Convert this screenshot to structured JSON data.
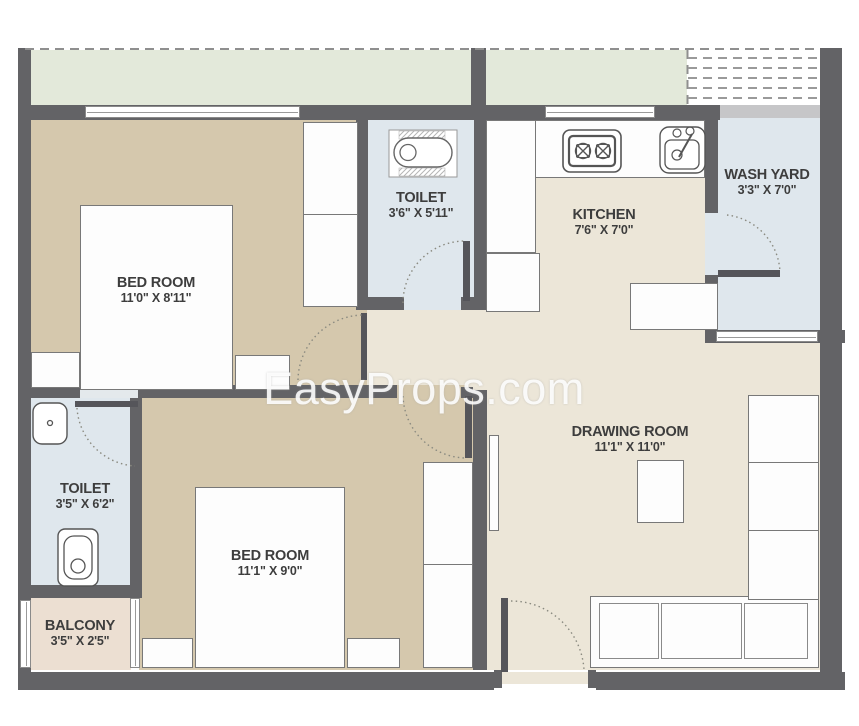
{
  "watermark": "EasyProps.com",
  "rooms": {
    "bedroom_top": {
      "name": "BED ROOM",
      "dims": "11'0\" X 8'11\""
    },
    "toilet_top": {
      "name": "TOILET",
      "dims": "3'6\" X 5'11\""
    },
    "kitchen": {
      "name": "KITCHEN",
      "dims": "7'6\" X 7'0\""
    },
    "wash_yard": {
      "name": "WASH YARD",
      "dims": "3'3\" X 7'0\""
    },
    "toilet_side": {
      "name": "TOILET",
      "dims": "3'5\" X 6'2\""
    },
    "bedroom_bottom": {
      "name": "BED ROOM",
      "dims": "11'1\" X 9'0\""
    },
    "balcony": {
      "name": "BALCONY",
      "dims": "3'5\" X 2'5\""
    },
    "drawing_room": {
      "name": "DRAWING ROOM",
      "dims": "11'1\" X 11'0\""
    }
  },
  "icons": [
    "bathtub-icon",
    "stove-icon",
    "kitchen-sink-icon",
    "washbasin-icon",
    "toilet-seat-icon"
  ],
  "colors": {
    "wall": "#636366",
    "bedroom_floor": "#d5c8ad",
    "toilet_floor": "#dfe7ed",
    "living_floor": "#ece6d8",
    "terrace_strip": "#e3e9da",
    "balcony_floor": "#ecdfd2",
    "window_band": "#c6c6c8",
    "label_text": "#3d3d3d"
  }
}
